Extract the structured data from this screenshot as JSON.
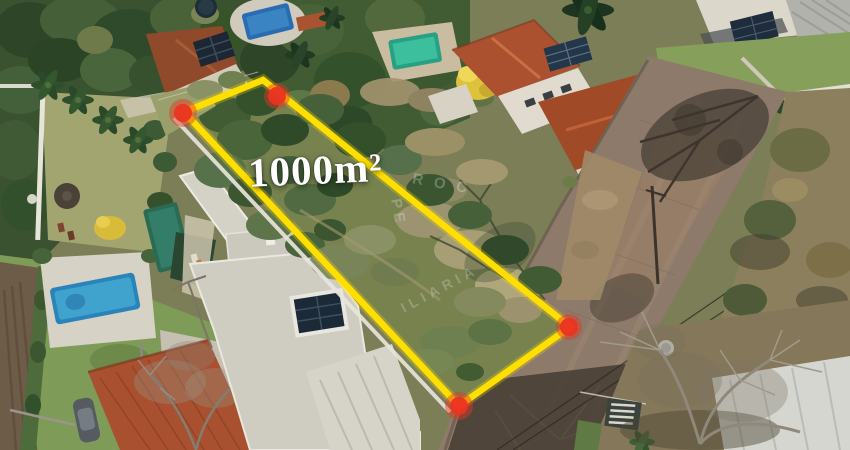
{
  "meta": {
    "type": "aerial-drone-photograph",
    "subject": "Vacant residential land lot outlined for sale, surrounded by houses with pools and a cobblestone street"
  },
  "annotation": {
    "area_label": "1000m²",
    "corner_marker_count": 4
  },
  "watermark": {
    "fragments": {
      "roc": "ROC",
      "pe": "PE",
      "iliaria": "ILIARIA"
    }
  },
  "colors": {
    "boundary": "#ffdf00",
    "marker": "#ea3421",
    "label": "#ffffff",
    "watermark": "#ffffff"
  },
  "scene_legend": {
    "lot": "overgrown vacant lot outlined in yellow",
    "left": "lawn with palm trees, thatched umbrella, blue pool, dark lap pool with shade canopy",
    "center_left": "modern flat-roof house with solar panels",
    "top": "tree canopy, small blue pool, green pool, terracotta-roof houses with solar panels",
    "top_right": "white house with grey metal roof and solar pergola",
    "right": "cobblestone street with tree shadows, power lines, dry scrub",
    "bottom_left": "terracotta-roof house, parked car, ploughed field strip",
    "bottom_right": "bare winter tree over white metal roof"
  }
}
